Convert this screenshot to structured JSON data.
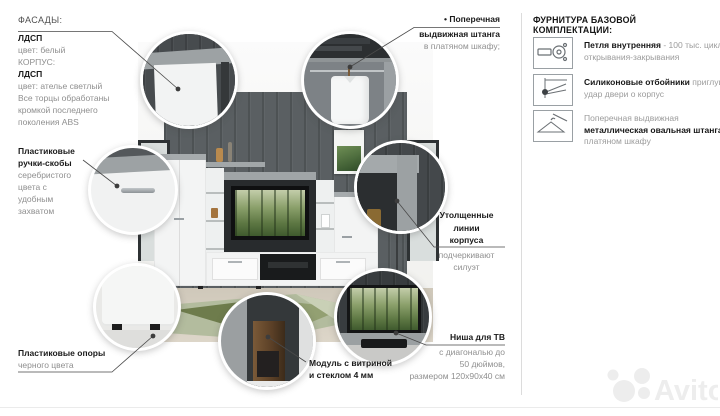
{
  "figure": {
    "facades": {
      "title": "ФАСАДЫ:",
      "l1": "ЛДСП",
      "l2": "цвет: белый",
      "l3": "КОРПУС:",
      "l4": "ЛДСП",
      "l5": "цвет: ателье светлый",
      "l6": "Все торцы обработаны",
      "l7": "кромкой последнего",
      "l8": "поколения ABS"
    },
    "handles": {
      "t1": "Пластиковые",
      "t2": "ручки-скобы",
      "d1": "серебристого",
      "d2": "цвета с",
      "d3": "удобным",
      "d4": "захватом"
    },
    "supports": {
      "title": "Пластиковые опоры",
      "desc": "черного цвета"
    },
    "rod": {
      "t1": "• Поперечная",
      "t2": "выдвижная штанга",
      "desc": "в платяном шкафу;"
    },
    "body": {
      "t1": "Утолщенные",
      "t2": "линии",
      "t3": "корпуса",
      "d1": "подчеркивают",
      "d2": "силуэт"
    },
    "tv": {
      "title": "Ниша для ТВ",
      "d1": "с диагональю до",
      "d2": "50 дюймов,",
      "d3": "размером 120x90x40 см"
    },
    "vitrine": {
      "t1": "Модуль с витриной",
      "t2": "и стеклом 4 мм"
    }
  },
  "hardware": {
    "header": "ФУРНИТУРА БАЗОВОЙ КОМПЛЕКТАЦИИ:",
    "item1": {
      "icon": "hinge-icon",
      "bold": "Петля внутренняя",
      "rest": " - 100 тыс. циклов открывания-закрывания"
    },
    "item2": {
      "icon": "door-bumper-icon",
      "bold": "Силиконовые отбойники",
      "rest": " приглушат удар двери о корпус"
    },
    "item3": {
      "icon": "hanger-rod-icon",
      "pre": "Поперечная выдвижная ",
      "bold": "металлическая овальная штанга",
      "post": " в платяном шкафу"
    }
  },
  "watermark": {
    "brand": "Avito"
  },
  "colors": {
    "concrete": "#a2a7a9",
    "wall": "#5a5f62",
    "title_text": "#1a1a1a",
    "body_text": "#8f8f8f",
    "watermark": "#ededed",
    "rug_green": "#6e7c4c"
  }
}
